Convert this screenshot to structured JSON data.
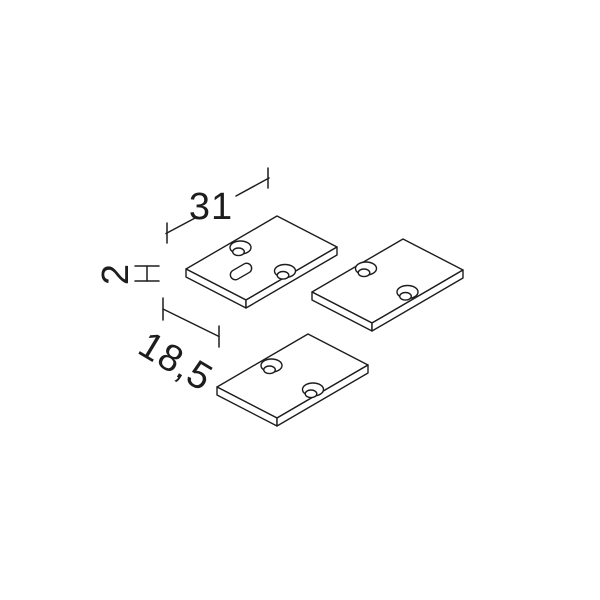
{
  "dims": {
    "length": "31",
    "thickness": "2",
    "depth": "18,5"
  },
  "colors": {
    "line": "#1d1d1d",
    "background": "#ffffff"
  },
  "parts": [
    {
      "name": "end-cap-plate-1",
      "position": "top-left",
      "countersunk_holes": 2,
      "slot_holes": 1
    },
    {
      "name": "end-cap-plate-2",
      "position": "right",
      "countersunk_holes": 2,
      "slot_holes": 0
    },
    {
      "name": "end-cap-plate-3",
      "position": "bottom",
      "countersunk_holes": 2,
      "slot_holes": 0
    }
  ]
}
